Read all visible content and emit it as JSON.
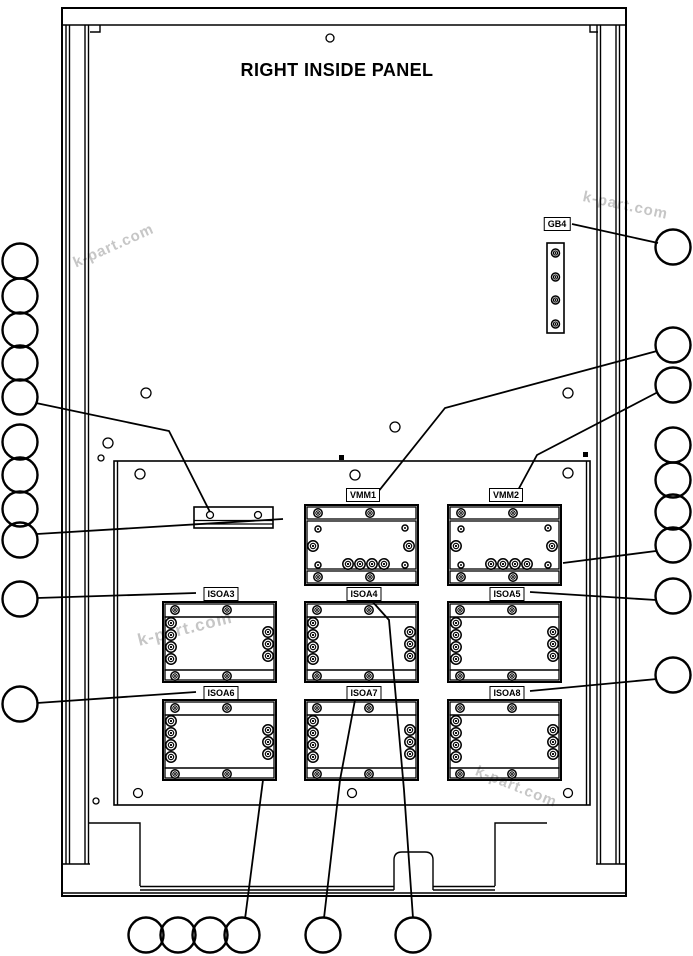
{
  "title": "RIGHT INSIDE PANEL",
  "colors": {
    "line": "#000000",
    "background": "#ffffff",
    "watermark": "#c6c6c6"
  },
  "watermarks": [
    {
      "text": "k-part.com",
      "x": 74,
      "y": 255,
      "rot": -24,
      "size": 15
    },
    {
      "text": "k-part.com",
      "x": 583,
      "y": 188,
      "rot": 12,
      "size": 15
    },
    {
      "text": "k-part.com",
      "x": 138,
      "y": 631,
      "rot": -14,
      "size": 17
    },
    {
      "text": "k-part.com",
      "x": 476,
      "y": 762,
      "rot": 22,
      "size": 15
    }
  ],
  "labels": [
    {
      "id": "gb4",
      "text": "GB4",
      "cx": 557,
      "top": 217
    },
    {
      "id": "vmm1",
      "text": "VMM1",
      "cx": 363,
      "top": 488
    },
    {
      "id": "vmm2",
      "text": "VMM2",
      "cx": 506,
      "top": 488
    },
    {
      "id": "isoa3",
      "text": "ISOA3",
      "cx": 221,
      "top": 587
    },
    {
      "id": "isoa4",
      "text": "ISOA4",
      "cx": 364,
      "top": 587
    },
    {
      "id": "isoa5",
      "text": "ISOA5",
      "cx": 507,
      "top": 587
    },
    {
      "id": "isoa6",
      "text": "ISOA6",
      "cx": 221,
      "top": 686
    },
    {
      "id": "isoa7",
      "text": "ISOA7",
      "cx": 364,
      "top": 686
    },
    {
      "id": "isoa8",
      "text": "ISOA8",
      "cx": 507,
      "top": 686
    }
  ],
  "diagram": {
    "modules": [
      {
        "type": "vmm",
        "label": "vmm1",
        "x": 305,
        "y": 505
      },
      {
        "type": "vmm",
        "label": "vmm2",
        "x": 448,
        "y": 505
      },
      {
        "type": "iso",
        "label": "isoa3",
        "x": 163,
        "y": 602
      },
      {
        "type": "iso",
        "label": "isoa4",
        "x": 305,
        "y": 602
      },
      {
        "type": "iso",
        "label": "isoa5",
        "x": 448,
        "y": 602
      },
      {
        "type": "iso",
        "label": "isoa6",
        "x": 163,
        "y": 700
      },
      {
        "type": "iso",
        "label": "isoa7",
        "x": 305,
        "y": 700
      },
      {
        "type": "iso",
        "label": "isoa8",
        "x": 448,
        "y": 700
      }
    ],
    "module_templates": {
      "vmm": {
        "w": 113,
        "h": 80,
        "bars": [
          [
            2,
            2,
            109,
            12
          ],
          [
            2,
            16,
            109,
            48
          ],
          [
            2,
            66,
            109,
            12
          ]
        ],
        "screws": [
          [
            13,
            8,
            4.2
          ],
          [
            65,
            8,
            4.2
          ],
          [
            13,
            24,
            3
          ],
          [
            100,
            23,
            3
          ],
          [
            8,
            41,
            5.2
          ],
          [
            104,
            41,
            5.2
          ],
          [
            13,
            60,
            3
          ],
          [
            100,
            60,
            3
          ],
          [
            43,
            59,
            5.2
          ],
          [
            55,
            59,
            5.2
          ],
          [
            67,
            59,
            5.2
          ],
          [
            79,
            59,
            5.2
          ],
          [
            13,
            72,
            4.2
          ],
          [
            65,
            72,
            4.2
          ]
        ]
      },
      "iso": {
        "w": 113,
        "h": 80,
        "bars": [
          [
            2,
            2,
            109,
            13
          ],
          [
            2,
            15,
            109,
            53
          ],
          [
            2,
            68,
            109,
            10
          ]
        ],
        "screws": [
          [
            12,
            8,
            4.2
          ],
          [
            64,
            8,
            4.2
          ],
          [
            8,
            21,
            5.2
          ],
          [
            8,
            33,
            5.2
          ],
          [
            8,
            45,
            5.2
          ],
          [
            8,
            57,
            5.2
          ],
          [
            105,
            30,
            5.2
          ],
          [
            105,
            42,
            5.2
          ],
          [
            105,
            54,
            5.2
          ],
          [
            12,
            74,
            4.2
          ],
          [
            64,
            74,
            4.2
          ]
        ]
      }
    },
    "gb4_strip": {
      "x": 547,
      "y": 243,
      "w": 17,
      "h": 90,
      "screws": [
        [
          555.5,
          253,
          4
        ],
        [
          555.5,
          277,
          4
        ],
        [
          555.5,
          300,
          4
        ],
        [
          555.5,
          324,
          4
        ]
      ]
    },
    "terminal_bar": {
      "x": 194,
      "y": 507,
      "w": 79,
      "h": 21,
      "lines": [
        [
          194,
          520.5,
          273,
          520.5
        ],
        [
          194,
          524,
          273,
          524
        ]
      ],
      "holes": [
        [
          210,
          515,
          3.5
        ],
        [
          258,
          515,
          3.5
        ]
      ]
    },
    "callouts": {
      "radius": 17.5,
      "left": [
        [
          20,
          261
        ],
        [
          20,
          296
        ],
        [
          20,
          330
        ],
        [
          20,
          363
        ],
        [
          20,
          397
        ],
        [
          20,
          442
        ],
        [
          20,
          475
        ],
        [
          20,
          509
        ],
        [
          20,
          540
        ],
        [
          20,
          599
        ],
        [
          20,
          704
        ]
      ],
      "right": [
        [
          673,
          247
        ],
        [
          673,
          345
        ],
        [
          673,
          385
        ],
        [
          673,
          445
        ],
        [
          673,
          480
        ],
        [
          673,
          512
        ],
        [
          673,
          545
        ],
        [
          673,
          596
        ],
        [
          673,
          675
        ]
      ],
      "bottom": [
        [
          146,
          935
        ],
        [
          178,
          935
        ],
        [
          210,
          935
        ],
        [
          242,
          935
        ],
        [
          323,
          935
        ],
        [
          413,
          935
        ]
      ]
    },
    "leaders": [
      [
        [
          572,
          224
        ],
        [
          658,
          243
        ]
      ],
      [
        [
          378,
          492
        ],
        [
          445,
          408
        ],
        [
          657,
          351
        ]
      ],
      [
        [
          517,
          492
        ],
        [
          537,
          455
        ],
        [
          658,
          392
        ]
      ],
      [
        [
          563,
          563
        ],
        [
          656,
          551
        ]
      ],
      [
        [
          530,
          592
        ],
        [
          656,
          600
        ]
      ],
      [
        [
          530,
          691
        ],
        [
          657,
          679
        ]
      ],
      [
        [
          36,
          403
        ],
        [
          169,
          431
        ],
        [
          210,
          512
        ]
      ],
      [
        [
          37,
          534
        ],
        [
          283,
          519
        ]
      ],
      [
        [
          37,
          598
        ],
        [
          196,
          593
        ]
      ],
      [
        [
          37,
          703
        ],
        [
          196,
          692
        ]
      ],
      [
        [
          263,
          780
        ],
        [
          245,
          919
        ]
      ],
      [
        [
          355,
          700
        ],
        [
          340,
          780
        ],
        [
          324,
          918
        ]
      ],
      [
        [
          371,
          600
        ],
        [
          389,
          620
        ],
        [
          404,
          790
        ],
        [
          413,
          918
        ]
      ]
    ],
    "holes": [
      [
        330,
        38,
        4
      ],
      [
        146,
        393,
        5
      ],
      [
        568,
        393,
        5
      ],
      [
        395,
        427,
        5
      ],
      [
        108,
        443,
        5
      ],
      [
        101,
        458,
        3
      ],
      [
        140,
        474,
        5
      ],
      [
        355,
        475,
        5
      ],
      [
        568,
        473,
        5
      ],
      [
        138,
        793,
        4.5
      ],
      [
        352,
        793,
        4.5
      ],
      [
        568,
        793,
        4.5
      ],
      [
        96,
        801,
        3
      ]
    ],
    "frame": {
      "rects": [
        [
          62,
          8,
          564,
          888,
          2,
          "outer-frame"
        ],
        [
          114,
          461,
          476,
          344,
          1.6,
          "inner-panel"
        ]
      ],
      "lines": [
        [
          62,
          25,
          626,
          25
        ],
        [
          66,
          25,
          66,
          864
        ],
        [
          69.5,
          25,
          69.5,
          864
        ],
        [
          85,
          25,
          85,
          864
        ],
        [
          88.5,
          25,
          88.5,
          864
        ],
        [
          597,
          25,
          597,
          864
        ],
        [
          600.5,
          25,
          600.5,
          864
        ],
        [
          616,
          25,
          616,
          864
        ],
        [
          619.5,
          25,
          619.5,
          864
        ],
        [
          62,
          864,
          90,
          864
        ],
        [
          596,
          864,
          626,
          864
        ],
        [
          117.5,
          461,
          117.5,
          805
        ],
        [
          586.5,
          461,
          586.5,
          805
        ],
        [
          62,
          893,
          626,
          893
        ],
        [
          140,
          886.5,
          394,
          886.5
        ],
        [
          433,
          886.5,
          495,
          886.5
        ],
        [
          140,
          890,
          394,
          890
        ],
        [
          433,
          890,
          495,
          890
        ]
      ],
      "polys": [
        [
          [
            88,
            823
          ],
          [
            140,
            823
          ],
          [
            140,
            886
          ]
        ],
        [
          [
            547,
            823
          ],
          [
            495,
            823
          ],
          [
            495,
            886
          ]
        ],
        [
          [
            90,
            32
          ],
          [
            100,
            32
          ],
          [
            100,
            25
          ]
        ],
        [
          [
            598,
            32
          ],
          [
            590,
            32
          ],
          [
            590,
            25
          ]
        ]
      ],
      "notch": "M394,890 L394,860 Q394,852 402,852 L425,852 Q433,852 433,860 L433,890",
      "squares": [
        [
          339,
          455,
          5,
          5
        ],
        [
          583,
          452,
          5,
          5
        ]
      ]
    }
  }
}
